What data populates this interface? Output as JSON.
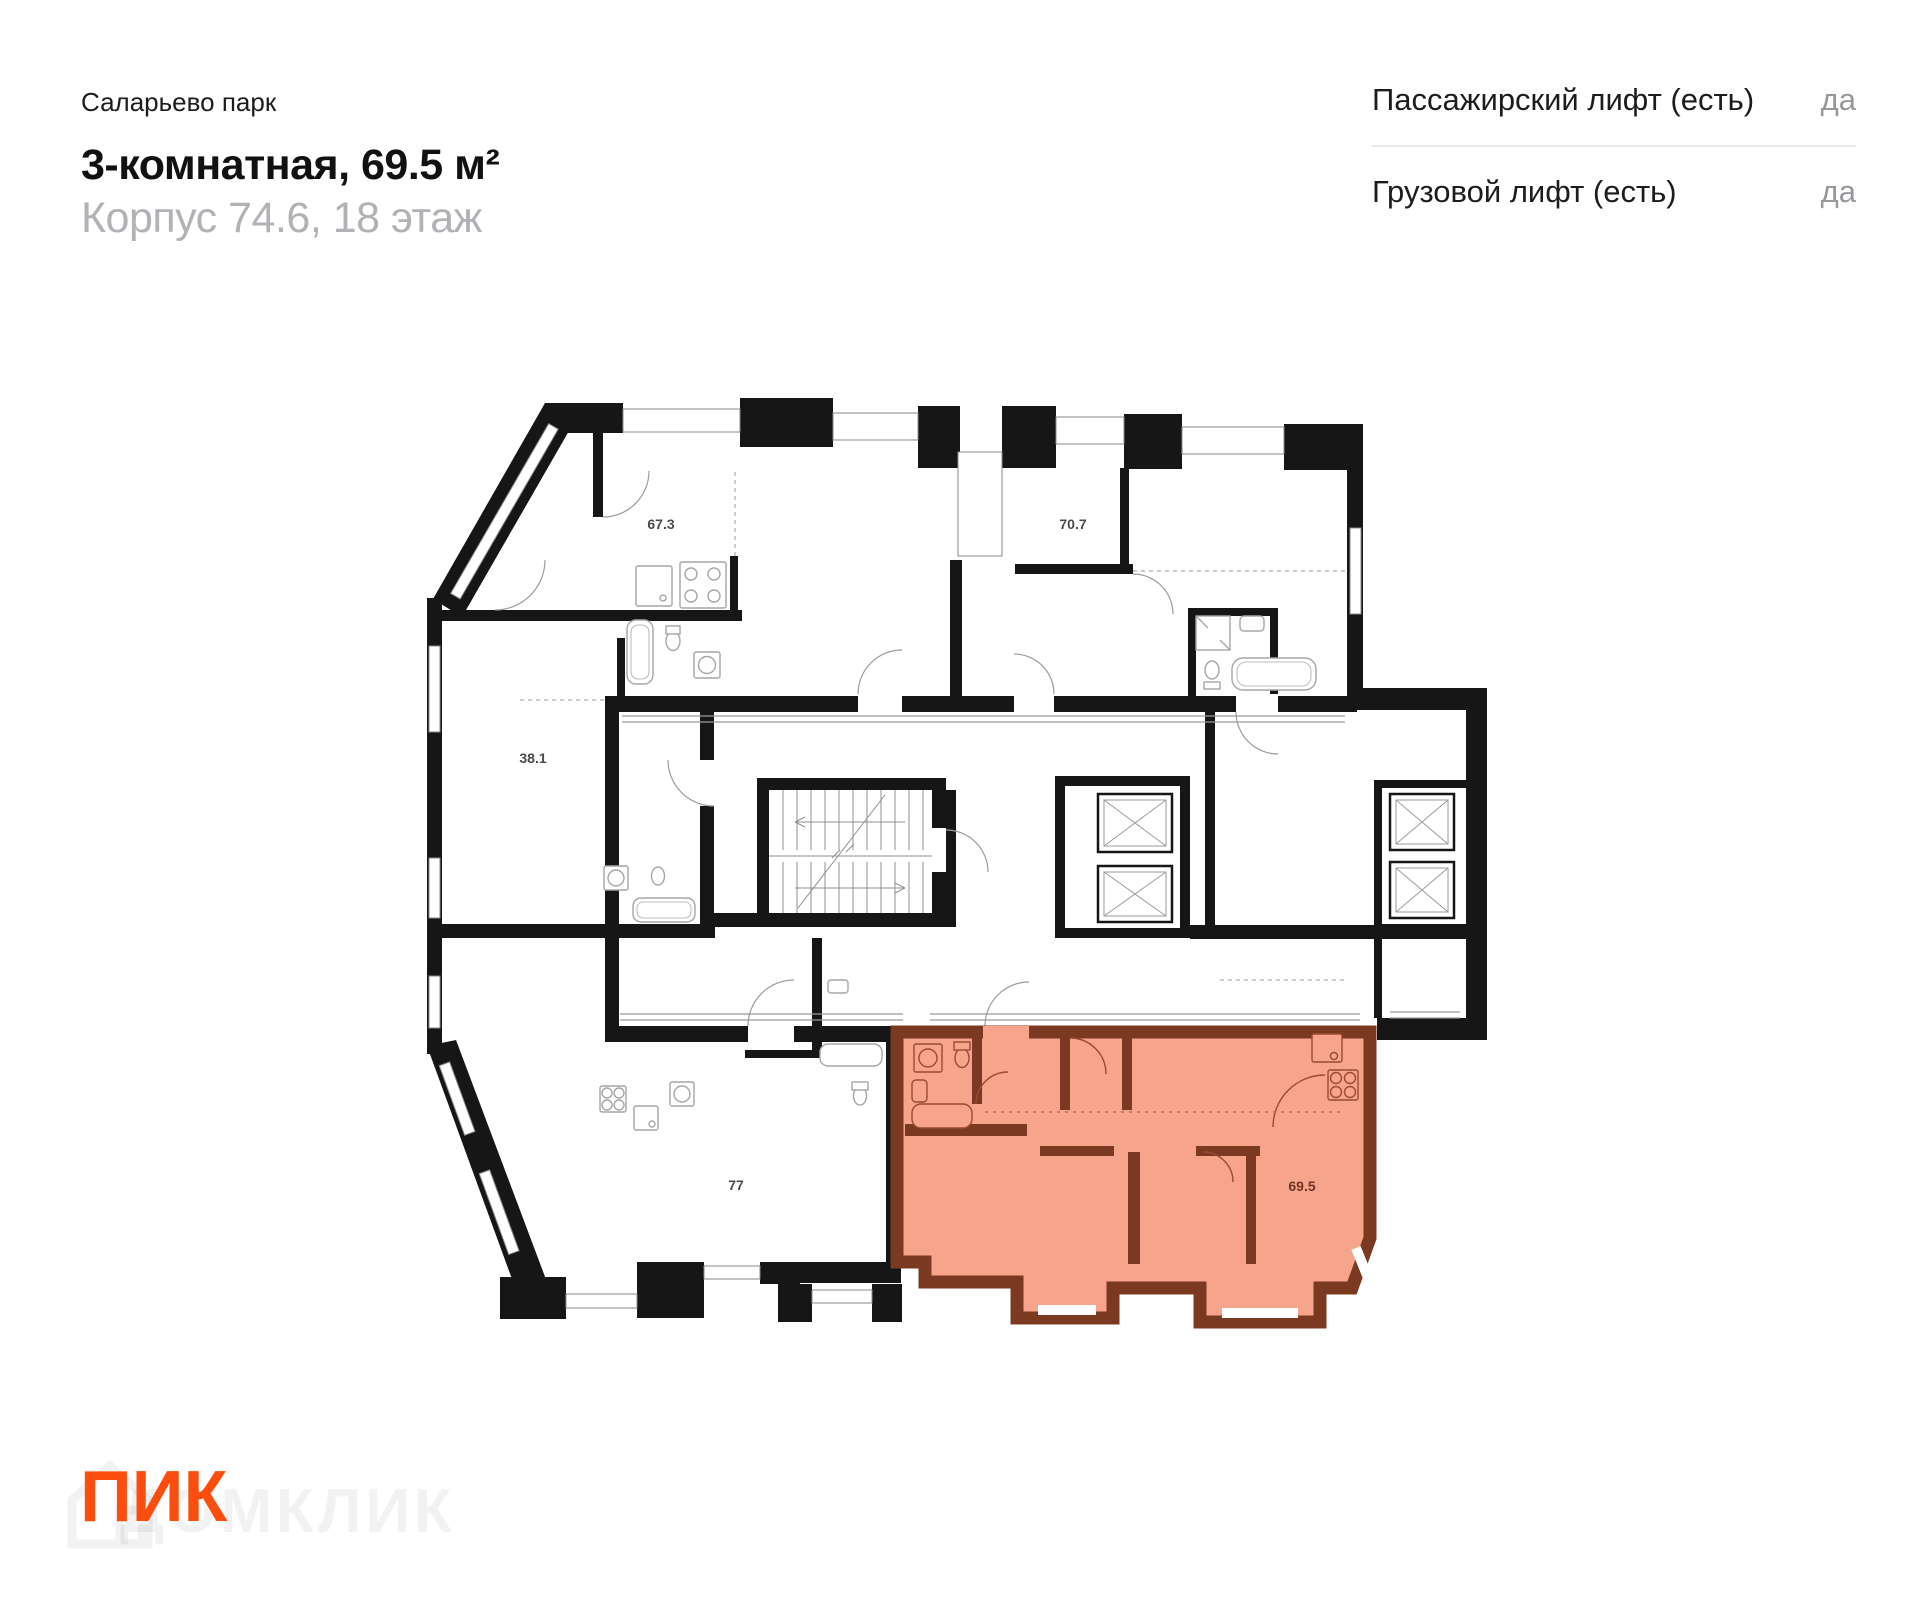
{
  "header": {
    "project": "Саларьево парк",
    "title": "3-комнатная, 69.5 м²",
    "subtitle": "Корпус 74.6, 18 этаж"
  },
  "info_panel": {
    "rows": [
      {
        "label": "Пассажирский лифт (есть)",
        "value": "да"
      },
      {
        "label": "Грузовой лифт (есть)",
        "value": "да"
      }
    ]
  },
  "floor_plan": {
    "area_labels": [
      {
        "id": "apartment-67-3",
        "text": "67.3",
        "highlighted": false
      },
      {
        "id": "apartment-70-7",
        "text": "70.7",
        "highlighted": false
      },
      {
        "id": "apartment-38-1",
        "text": "38.1",
        "highlighted": false
      },
      {
        "id": "apartment-77",
        "text": "77",
        "highlighted": false
      },
      {
        "id": "apartment-69-5",
        "text": "69.5",
        "highlighted": true
      }
    ]
  },
  "footer": {
    "logo": "ПИК",
    "watermark": "ДОМКЛИК"
  },
  "colors": {
    "walls": "#161616",
    "highlight_fill": "#F7A48D",
    "highlight_wall": "#7C3922",
    "highlight_label": "#703421",
    "logo": "#FB4E0E",
    "subtitle_gray": "#B1B1B6",
    "value_gray": "#97979C",
    "divider": "#E8E8E8"
  }
}
